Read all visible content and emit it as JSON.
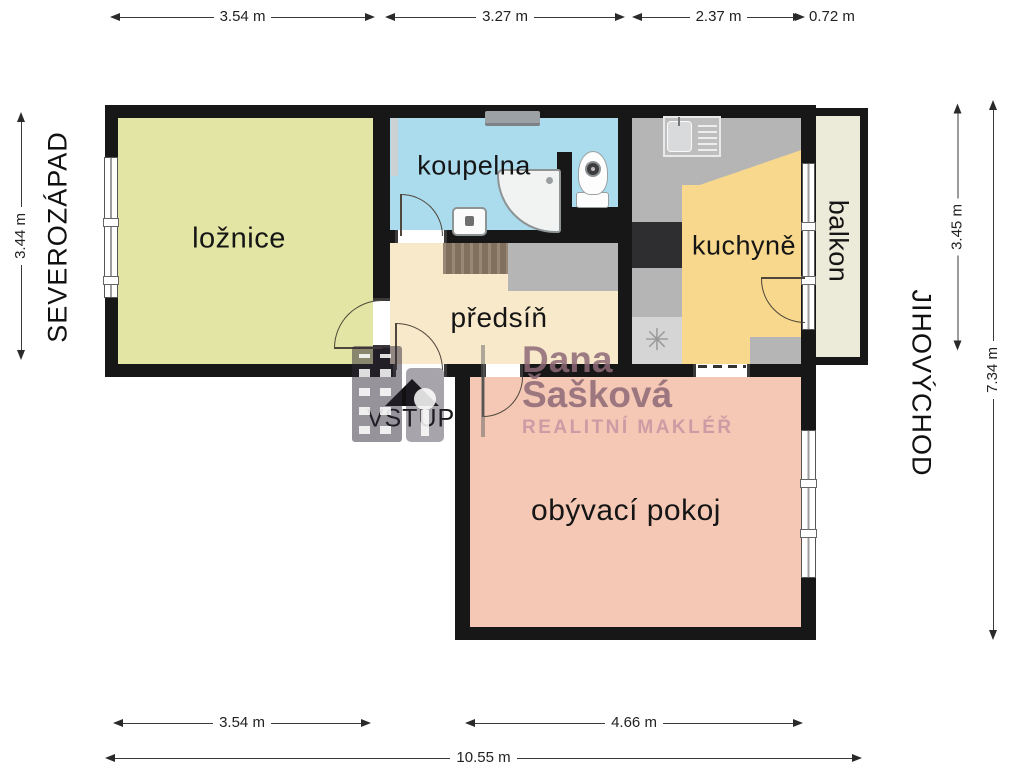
{
  "plan_title": "apartment-floor-plan",
  "rooms": [
    {
      "id": "loznice",
      "label": "ložnice",
      "color": "#e2e5a3"
    },
    {
      "id": "koupelna",
      "label": "koupelna",
      "color": "#aadcee"
    },
    {
      "id": "predsin",
      "label": "předsíň",
      "color": "#f9e9cb"
    },
    {
      "id": "kuchyne",
      "label": "kuchyně",
      "color": "#f7d88d"
    },
    {
      "id": "balkon",
      "label": "balkon",
      "color": "#ecead8"
    },
    {
      "id": "obyvaci_pokoj",
      "label": "obývací pokoj",
      "color": "#f4c8b4"
    }
  ],
  "entrance": {
    "label": "VSTUP"
  },
  "compass": {
    "northwest": "SEVEROZÁPAD",
    "southeast": "JIHOVÝCHOD"
  },
  "dimensions": {
    "top": [
      "3.54 m",
      "3.27 m",
      "2.37 m",
      "0.72 m"
    ],
    "bottom": [
      "3.54 m",
      "4.66 m",
      "10.55 m"
    ],
    "left": [
      "3.44 m"
    ],
    "right": [
      "3.45 m",
      "7.34 m"
    ]
  },
  "watermark": {
    "line1": "Dana",
    "line2": "Šašková",
    "line3": "REALITNÍ MAKLÉŘ"
  },
  "icons": {
    "fan": "✳"
  },
  "colors": {
    "wall": "#171717",
    "floor_gray": "#b5b5b6",
    "appliance_dark": "#2e2e30",
    "wood_rug": "#8d7a66",
    "watermark_name": "rgba(141,104,119,0.85)",
    "watermark_sub": "rgba(198,151,163,0.9)"
  }
}
